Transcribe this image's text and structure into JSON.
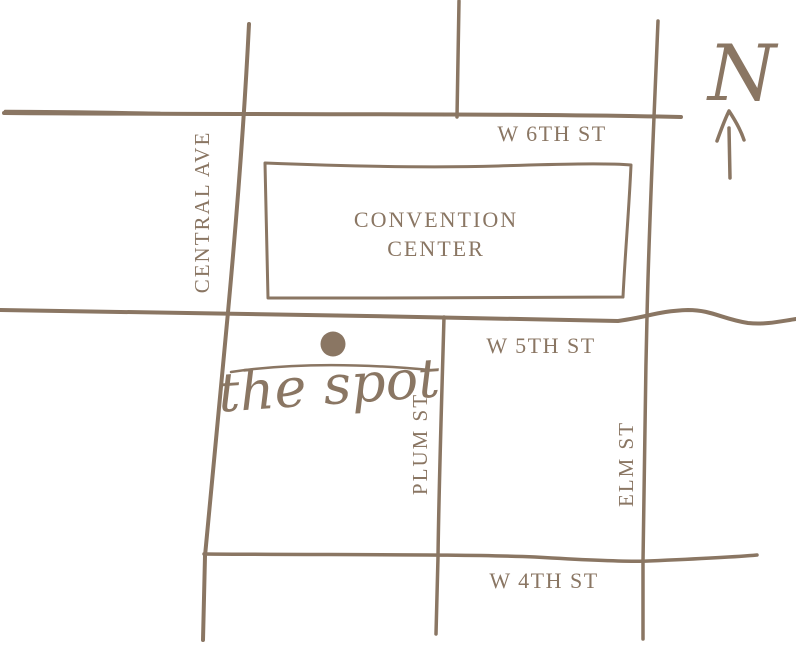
{
  "page": {
    "background": "#FFFFFF",
    "ink": "#8A7663"
  },
  "compass": {
    "label": "N"
  },
  "marker": {
    "label": "the spot"
  },
  "landmark": {
    "line1": "CONVENTION",
    "line2": "CENTER"
  },
  "streets": [
    {
      "name": "W 6TH ST",
      "orientation": "horizontal"
    },
    {
      "name": "W 5TH ST",
      "orientation": "horizontal"
    },
    {
      "name": "W 4TH ST",
      "orientation": "horizontal"
    },
    {
      "name": "CENTRAL AVE",
      "orientation": "vertical"
    },
    {
      "name": "PLUM ST",
      "orientation": "vertical"
    },
    {
      "name": "ELM ST",
      "orientation": "vertical"
    }
  ]
}
